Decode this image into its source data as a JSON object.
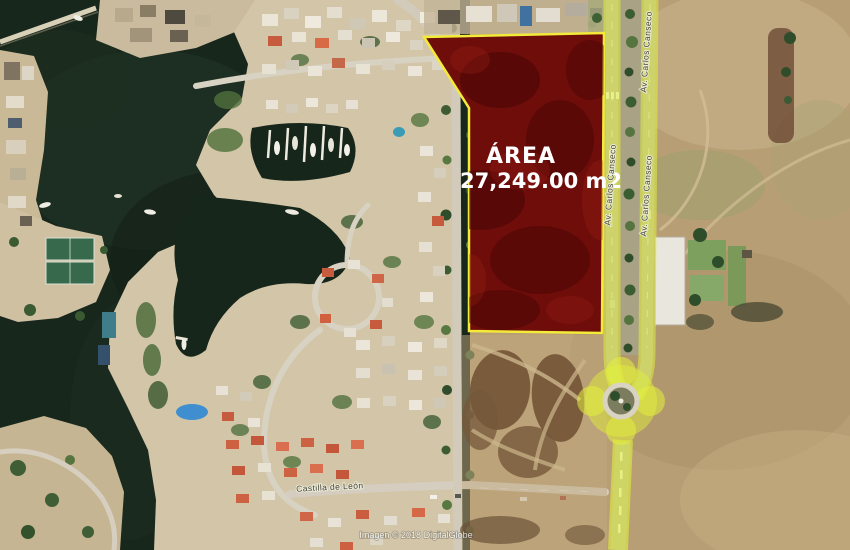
{
  "map": {
    "parcel": {
      "area_title": "ÁREA",
      "area_value": "27,249.00 m2"
    },
    "streets": {
      "avenue_name": "Av. Carlos Canseco",
      "castilla_name": "Castilla de León"
    },
    "attribution": "Imagen © 2018 DigitalGlobe",
    "colors": {
      "parcel_fill": "#6e0d0a",
      "parcel_outline": "#f3ea3a",
      "road_highlight": "#e0ee3e",
      "water": "#18271c",
      "terrain": "#b89e74"
    }
  }
}
